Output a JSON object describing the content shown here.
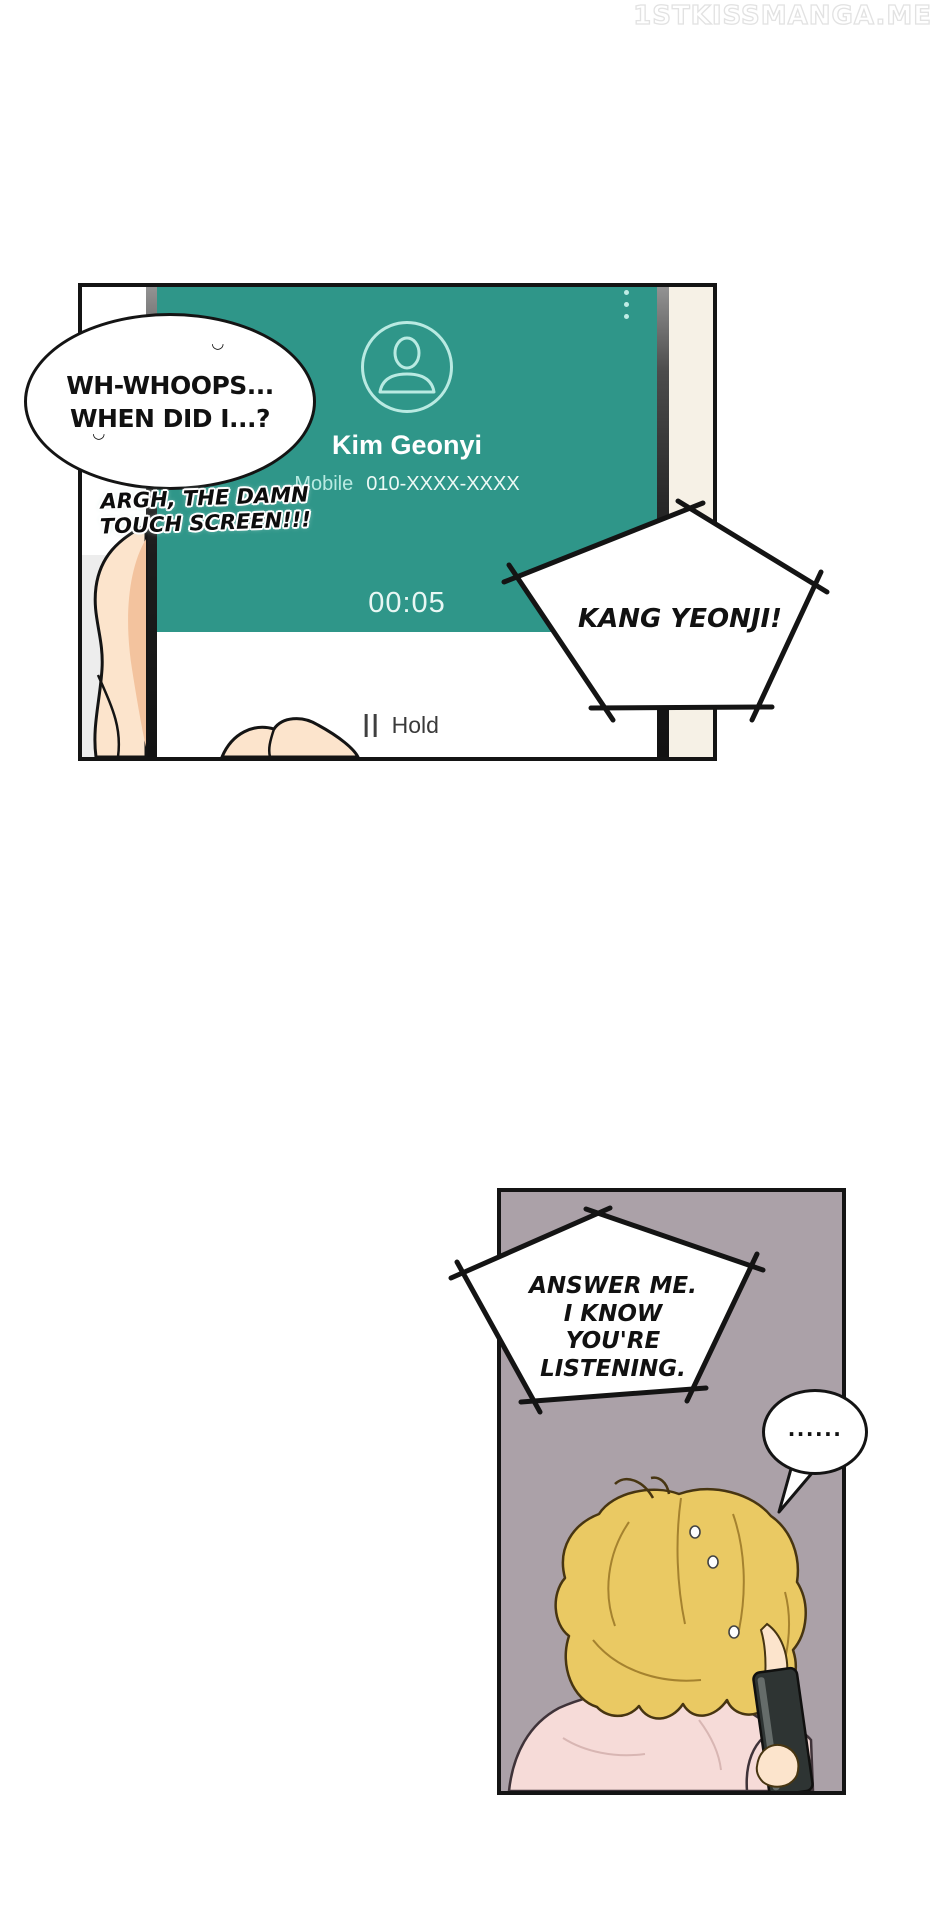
{
  "watermark": {
    "text": "1STKISSMANGA.ME"
  },
  "colors": {
    "phone_screen_teal": "#2f9689",
    "phone_ui_aqua": "#b9eae2",
    "panel2_background_mauve": "#aba1a8",
    "panel_background_cream": "#f6f1e6",
    "skin_light": "#fce4cc",
    "skin_shadow": "#f3c39e",
    "hair_blonde": "#eac963",
    "shirt_pink": "#f6dbd8",
    "ink_black": "#141414",
    "watermark_outline": "#e2e2e2"
  },
  "panel1": {
    "phone_ui": {
      "contact_name": "Kim Geonyi",
      "phone_label": "Mobile",
      "phone_number": "010-XXXX-XXXX",
      "call_timer": "00:05",
      "hold_label": "Hold"
    },
    "bubble_whoops": {
      "line1": "WH-WHOOPS...",
      "line2": "WHEN DID I...?",
      "breath_mark": "◡"
    },
    "caption": {
      "line1": "ARGH, THE DAMN",
      "line2": "TOUCH SCREEN!!!"
    },
    "shout": {
      "text": "KANG YEONJI!"
    }
  },
  "panel2": {
    "shout": {
      "line1": "ANSWER ME.",
      "line2": "I KNOW YOU'RE",
      "line3": "LISTENING."
    },
    "bubble_dots": {
      "text": "......"
    }
  }
}
